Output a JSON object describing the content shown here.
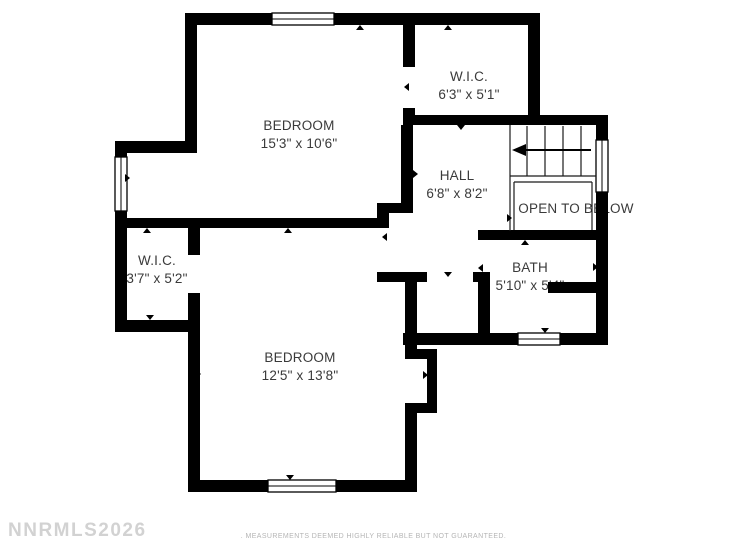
{
  "plan": {
    "title": "Upper floor plan",
    "rooms": [
      {
        "name": "BEDROOM",
        "dims": "15'3\" x 10'6\""
      },
      {
        "name": "W.I.C.",
        "dims": "6'3\" x 5'1\""
      },
      {
        "name": "HALL",
        "dims": "6'8\" x 8'2\""
      },
      {
        "name": "OPEN TO BELOW",
        "dims": ""
      },
      {
        "name": "W.I.C.",
        "dims": "3'7\" x 5'2\""
      },
      {
        "name": "BATH",
        "dims": "5'10\" x 5'4\""
      },
      {
        "name": "BEDROOM",
        "dims": "12'5\" x 13'8\""
      }
    ],
    "icons": {
      "stair_arrow": "◀",
      "door_marker": "▲"
    },
    "colors": {
      "walls": "#000000",
      "background": "#ffffff",
      "label_text": "#3a3a3a",
      "watermark": "#d2d2d2",
      "disclaimer": "#b5b5b5"
    }
  },
  "footer": {
    "watermark": "NNRMLS2026",
    "disclaimer": ". MEASUREMENTS DEEMED HIGHLY RELIABLE BUT NOT GUARANTEED."
  }
}
